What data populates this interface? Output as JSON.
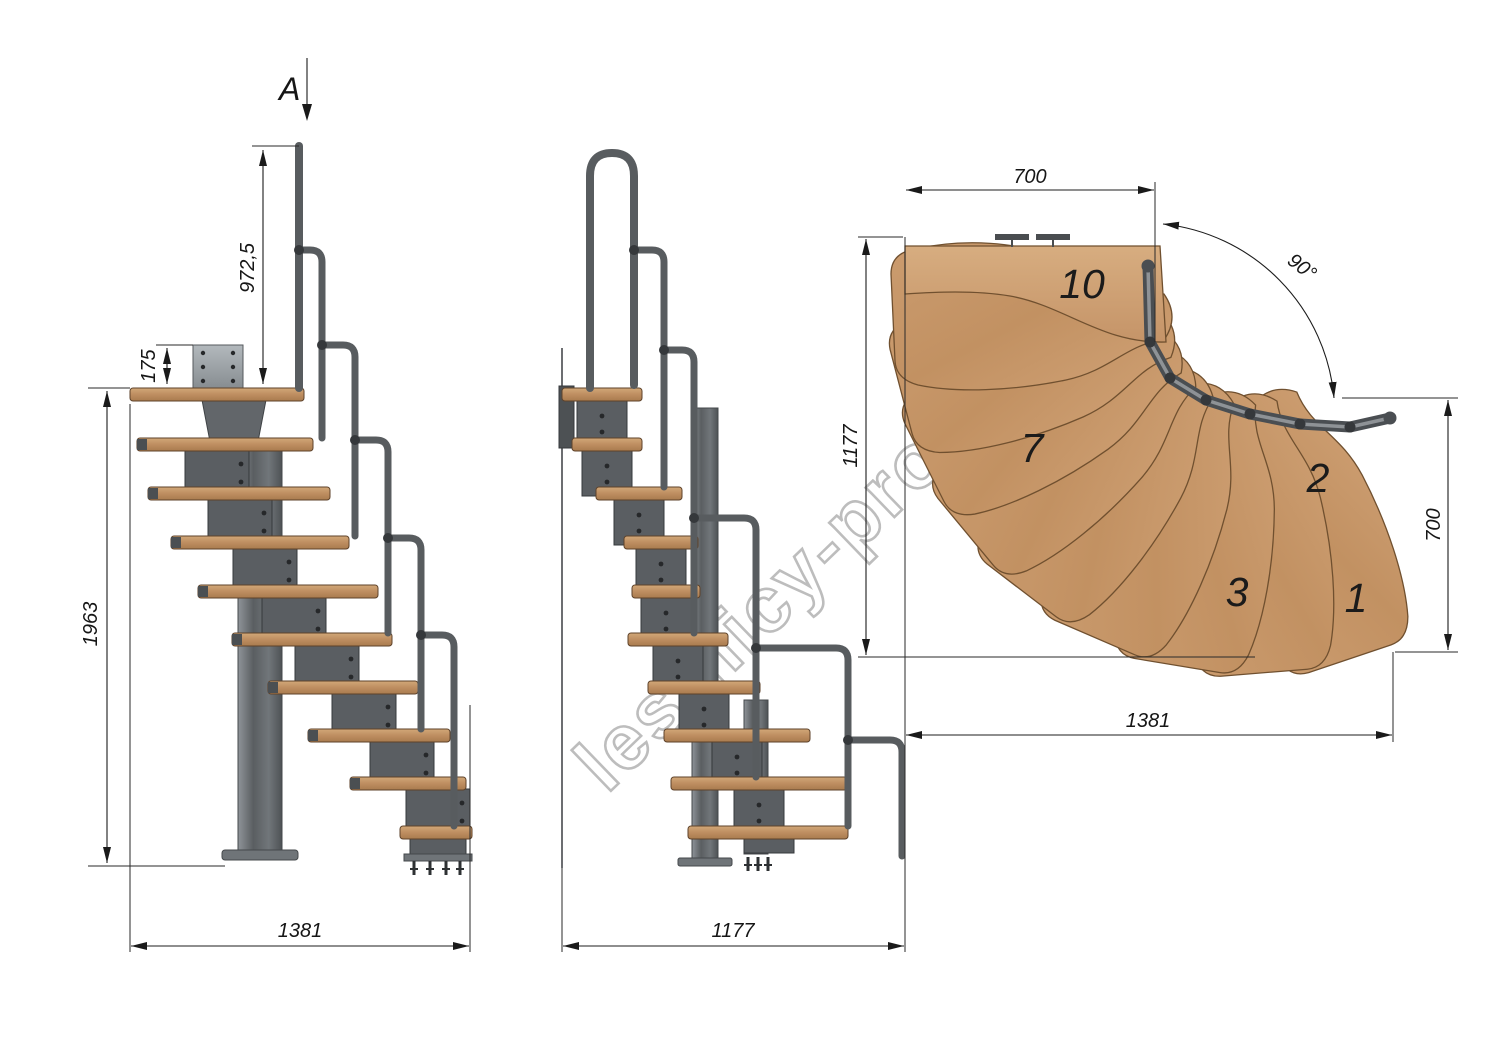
{
  "watermark": {
    "text": "lestnicy-prosto.ru"
  },
  "labels": {
    "section_arrow": "A",
    "side_rail_height": "972,5",
    "side_plate_offset": "175",
    "side_total_height": "1963",
    "side_total_length": "1381",
    "front_total_width": "1177",
    "plan_landing_width": "700",
    "plan_turn_angle": "90°",
    "plan_side_depth": "1177",
    "plan_entry_depth": "700",
    "plan_total_length": "1381",
    "plan_tread_1": "1",
    "plan_tread_2": "2",
    "plan_tread_3": "3",
    "plan_tread_7": "7",
    "plan_tread_10": "10"
  },
  "colors": {
    "wood_light": "#d2a878",
    "wood_dark": "#a97b4e",
    "metal": "#5a5e62",
    "metal_light": "#9aa0a4",
    "dimension_line": "#1c1c1c",
    "watermark_stroke": "#bdbdbd"
  }
}
